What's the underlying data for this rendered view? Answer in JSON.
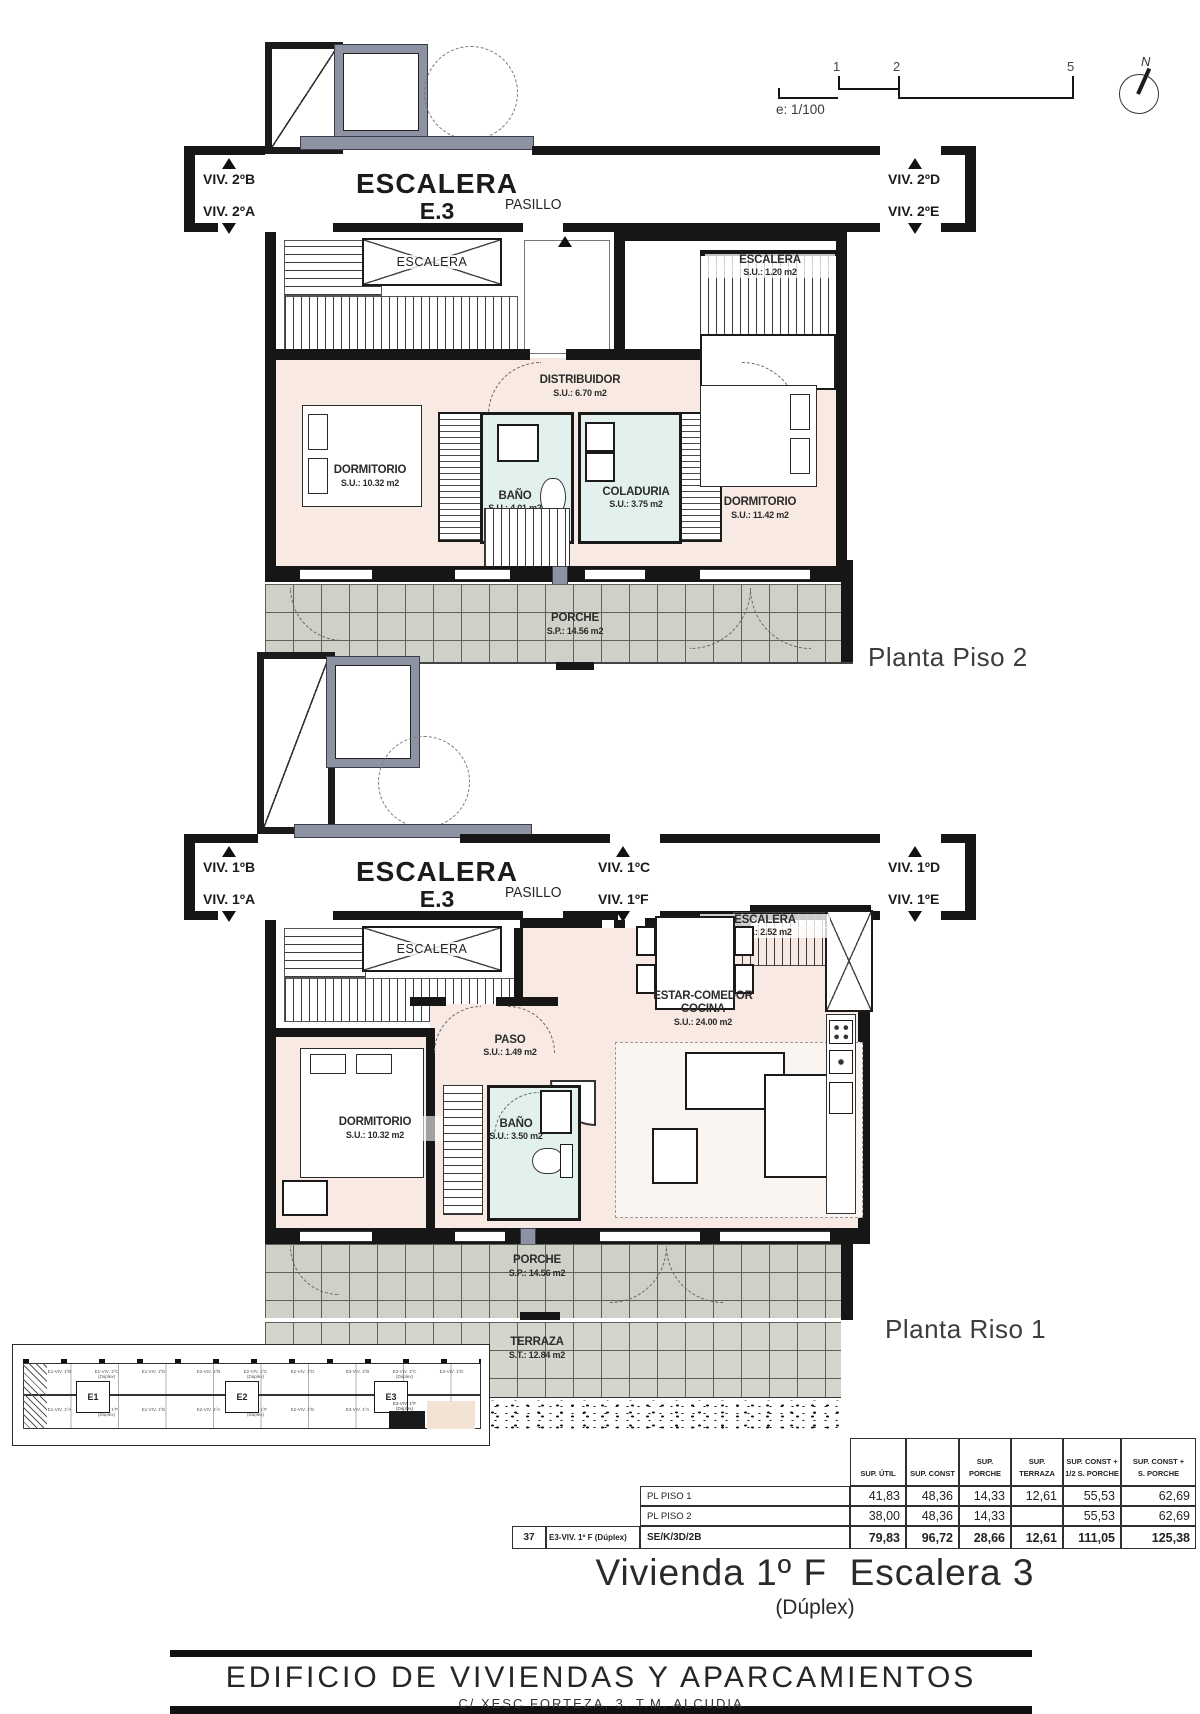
{
  "meta": {
    "scale_label": "e: 1/100",
    "scale_ticks": [
      "1",
      "2",
      "5"
    ],
    "north_label": "N"
  },
  "colors": {
    "room_pink": "#f8eae2",
    "wet_room_cyan": "#e2f1ee",
    "porch_gray": "#cdd1c7",
    "wall_black": "#161616",
    "elevator_slate": "#8e93a4",
    "highlight_beige": "#f2e3d5"
  },
  "plan2": {
    "title": "Planta Piso 2",
    "stair_main": "ESCALERA",
    "stair_sub": "E.3",
    "pasillo": "PASILLO",
    "stairbox": "ESCALERA",
    "units": {
      "lt": "VIV. 2ºB",
      "lb": "VIV. 2ºA",
      "rt": "VIV. 2ºD",
      "rb": "VIV. 2ºE"
    },
    "rooms": {
      "stair_up": {
        "name": "ESCALERA",
        "area": "S.U.: 1.20 m2"
      },
      "distribuidor": {
        "name": "DISTRIBUIDOR",
        "area": "S.U.: 6.70 m2"
      },
      "dormitorio1": {
        "name": "DORMITORIO",
        "area": "S.U.: 10.32 m2"
      },
      "bano": {
        "name": "BAÑO",
        "area": "S.U.: 4.01 m2"
      },
      "coladuria": {
        "name": "COLADURIA",
        "area": "S.U.: 3.75 m2"
      },
      "dormitorio2": {
        "name": "DORMITORIO",
        "area": "S.U.: 11.42 m2"
      },
      "porche": {
        "name": "PORCHE",
        "area": "S.P.: 14.56 m2"
      }
    }
  },
  "plan1": {
    "title": "Planta Riso 1",
    "stair_main": "ESCALERA",
    "stair_sub": "E.3",
    "pasillo": "PASILLO",
    "stairbox": "ESCALERA",
    "units": {
      "lt": "VIV. 1ºB",
      "lb": "VIV. 1ºA",
      "mt": "VIV. 1ºC",
      "mb": "VIV. 1ºF",
      "rt": "VIV. 1ºD",
      "rb": "VIV. 1ºE"
    },
    "rooms": {
      "stair_up": {
        "name": "ESCALERA",
        "area": "S.U.: 2.52 m2"
      },
      "estar": {
        "name": "ESTAR-COMEDOR",
        "name2": "COCINA",
        "area": "S.U.: 24.00 m2"
      },
      "paso": {
        "name": "PASO",
        "area": "S.U.: 1.49 m2"
      },
      "dormitorio": {
        "name": "DORMITORIO",
        "area": "S.U.: 10.32 m2"
      },
      "bano": {
        "name": "BAÑO",
        "area": "S.U.: 3.50 m2"
      },
      "porche": {
        "name": "PORCHE",
        "area": "S.P.: 14.56 m2"
      },
      "terraza": {
        "name": "TERRAZA",
        "area": "S.T.: 12.84 m2"
      }
    }
  },
  "site": {
    "blocks": [
      {
        "id": "E1",
        "units": [
          "E1-VIV. 1ºB",
          "E1-VIV. 1ºC\n(Dúplex)",
          "E1-VIV. 1ºD",
          "E1-VIV. 1ºA",
          "E1-VIV. 1ºF\n(Dúplex)",
          "E1-VIV. 1ºE"
        ]
      },
      {
        "id": "E2",
        "units": [
          "E2-VIV. 1ºB",
          "E2-VIV. 1ºC\n(Dúplex)",
          "E2-VIV. 1ºD",
          "E2-VIV. 1ºA",
          "E2-VIV. 1ºF\n(Dúplex)",
          "E2-VIV. 1ºE"
        ]
      },
      {
        "id": "E3",
        "units": [
          "E3-VIV. 1ºB",
          "E3-VIV. 1ºC\n(Dúplex)",
          "E3-VIV. 1ºD",
          "E3-VIV. 1ºA",
          "E3-VIV. 1ºF\n(Dúplex)",
          "E3-VIV. 1ºE"
        ]
      }
    ]
  },
  "table": {
    "headers": [
      "SUP. ÚTIL",
      "SUP. CONST",
      "SUP. PORCHE",
      "SUP. TERRAZA",
      "SUP. CONST +\n1/2 S. PORCHE",
      "SUP. CONST +\nS. PORCHE"
    ],
    "rows": [
      {
        "label": "PL PISO 1",
        "values": [
          "41,83",
          "48,36",
          "14,33",
          "12,61",
          "55,53",
          "62,69"
        ]
      },
      {
        "label": "PL PISO 2",
        "values": [
          "38,00",
          "48,36",
          "14,33",
          "",
          "55,53",
          "62,69"
        ]
      }
    ],
    "total": {
      "num": "37",
      "name": "E3-VIV. 1º F (Dúplex)",
      "code": "SE/K/3D/2B",
      "values": [
        "79,83",
        "96,72",
        "28,66",
        "12,61",
        "111,05",
        "125,38"
      ]
    }
  },
  "title_block": {
    "line1": "Vivienda 1º F  Escalera 3",
    "line2": "(Dúplex)"
  },
  "footer": {
    "line1": "EDIFICIO DE VIVIENDAS Y APARCAMIENTOS",
    "line2": "C/ XESC FORTEZA, 3. T.M. ALCUDIA"
  }
}
